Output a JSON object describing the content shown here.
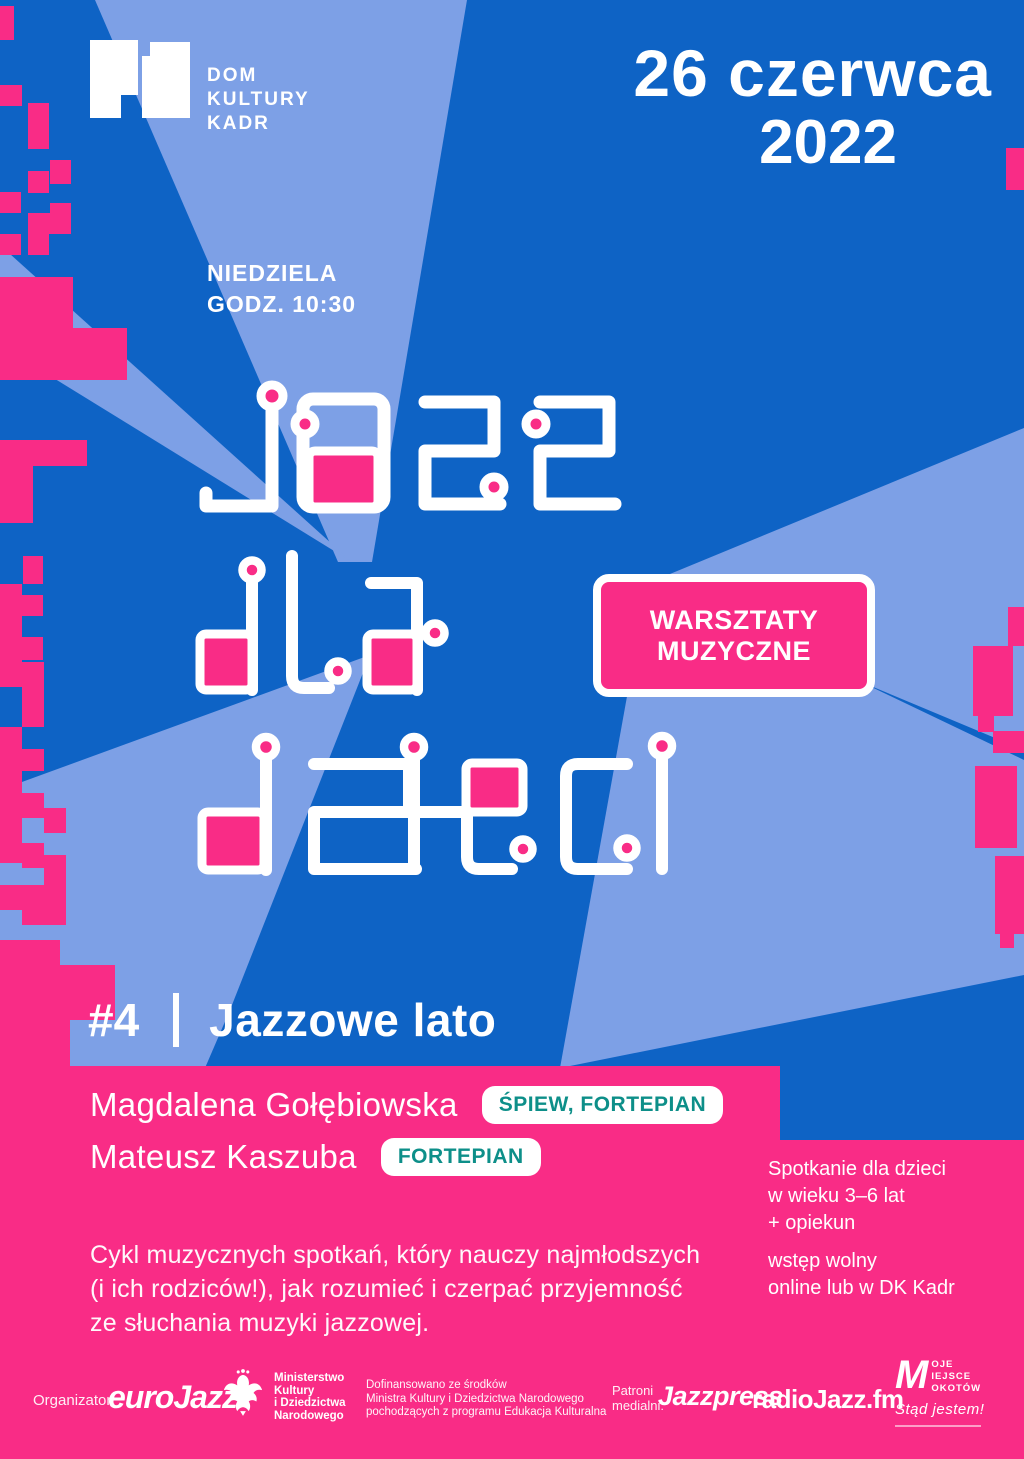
{
  "colors": {
    "blue": "#0e63c5",
    "light_blue": "#7da0e6",
    "pink": "#f92c86",
    "teal": "#0d8f89",
    "white": "#ffffff"
  },
  "header": {
    "venue_lines": [
      "DOM",
      "KULTURY",
      "KADR"
    ],
    "date_line1": "26 czerwca",
    "date_line2": "2022",
    "weekday": "NIEDZIELA",
    "time_label": "GODZ. 10:30"
  },
  "title": {
    "text": "Jazz dla dzieci",
    "words": [
      "Jazz",
      "dla",
      "dzieci"
    ]
  },
  "workshop_badge": {
    "line1": "WARSZTATY",
    "line2": "MUZYCZNE"
  },
  "episode": {
    "number": "#4",
    "title": "Jazzowe lato"
  },
  "performers": [
    {
      "name": "Magdalena Gołębiowska",
      "role": "ŚPIEW, FORTEPIAN"
    },
    {
      "name": "Mateusz Kaszuba",
      "role": "FORTEPIAN"
    }
  ],
  "info": {
    "audience_lines": [
      "Spotkanie dla dzieci",
      "w wieku 3–6 lat",
      "+ opiekun"
    ],
    "admission_lines": [
      "wstęp wolny",
      "online lub w DK Kadr"
    ]
  },
  "description_lines": [
    "Cykl muzycznych spotkań, który nauczy najmłodszych",
    "(i ich rodziców!), jak rozumieć i czerpać przyjemność",
    "ze słuchania muzyki jazzowej."
  ],
  "footer": {
    "organizer_label": "Organizator:",
    "organizer_logo": "euroJazz",
    "ministry_lines": [
      "Ministerstwo",
      "Kultury",
      "i Dziedzictwa",
      "Narodowego"
    ],
    "funding_lines": [
      "Dofinansowano ze środków",
      "Ministra Kultury i Dziedzictwa Narodowego",
      "pochodzących z programu Edukacja Kulturalna"
    ],
    "patrons_label_lines": [
      "Patroni",
      "medialni:"
    ],
    "patron_jazzpress": "Jazzpress",
    "patron_radiojazz": "radioJazz.fm",
    "mmm": {
      "initial": "M",
      "lines": [
        "oje",
        "iejsce",
        "okotów"
      ],
      "slogan": "Stąd jestem!"
    }
  }
}
